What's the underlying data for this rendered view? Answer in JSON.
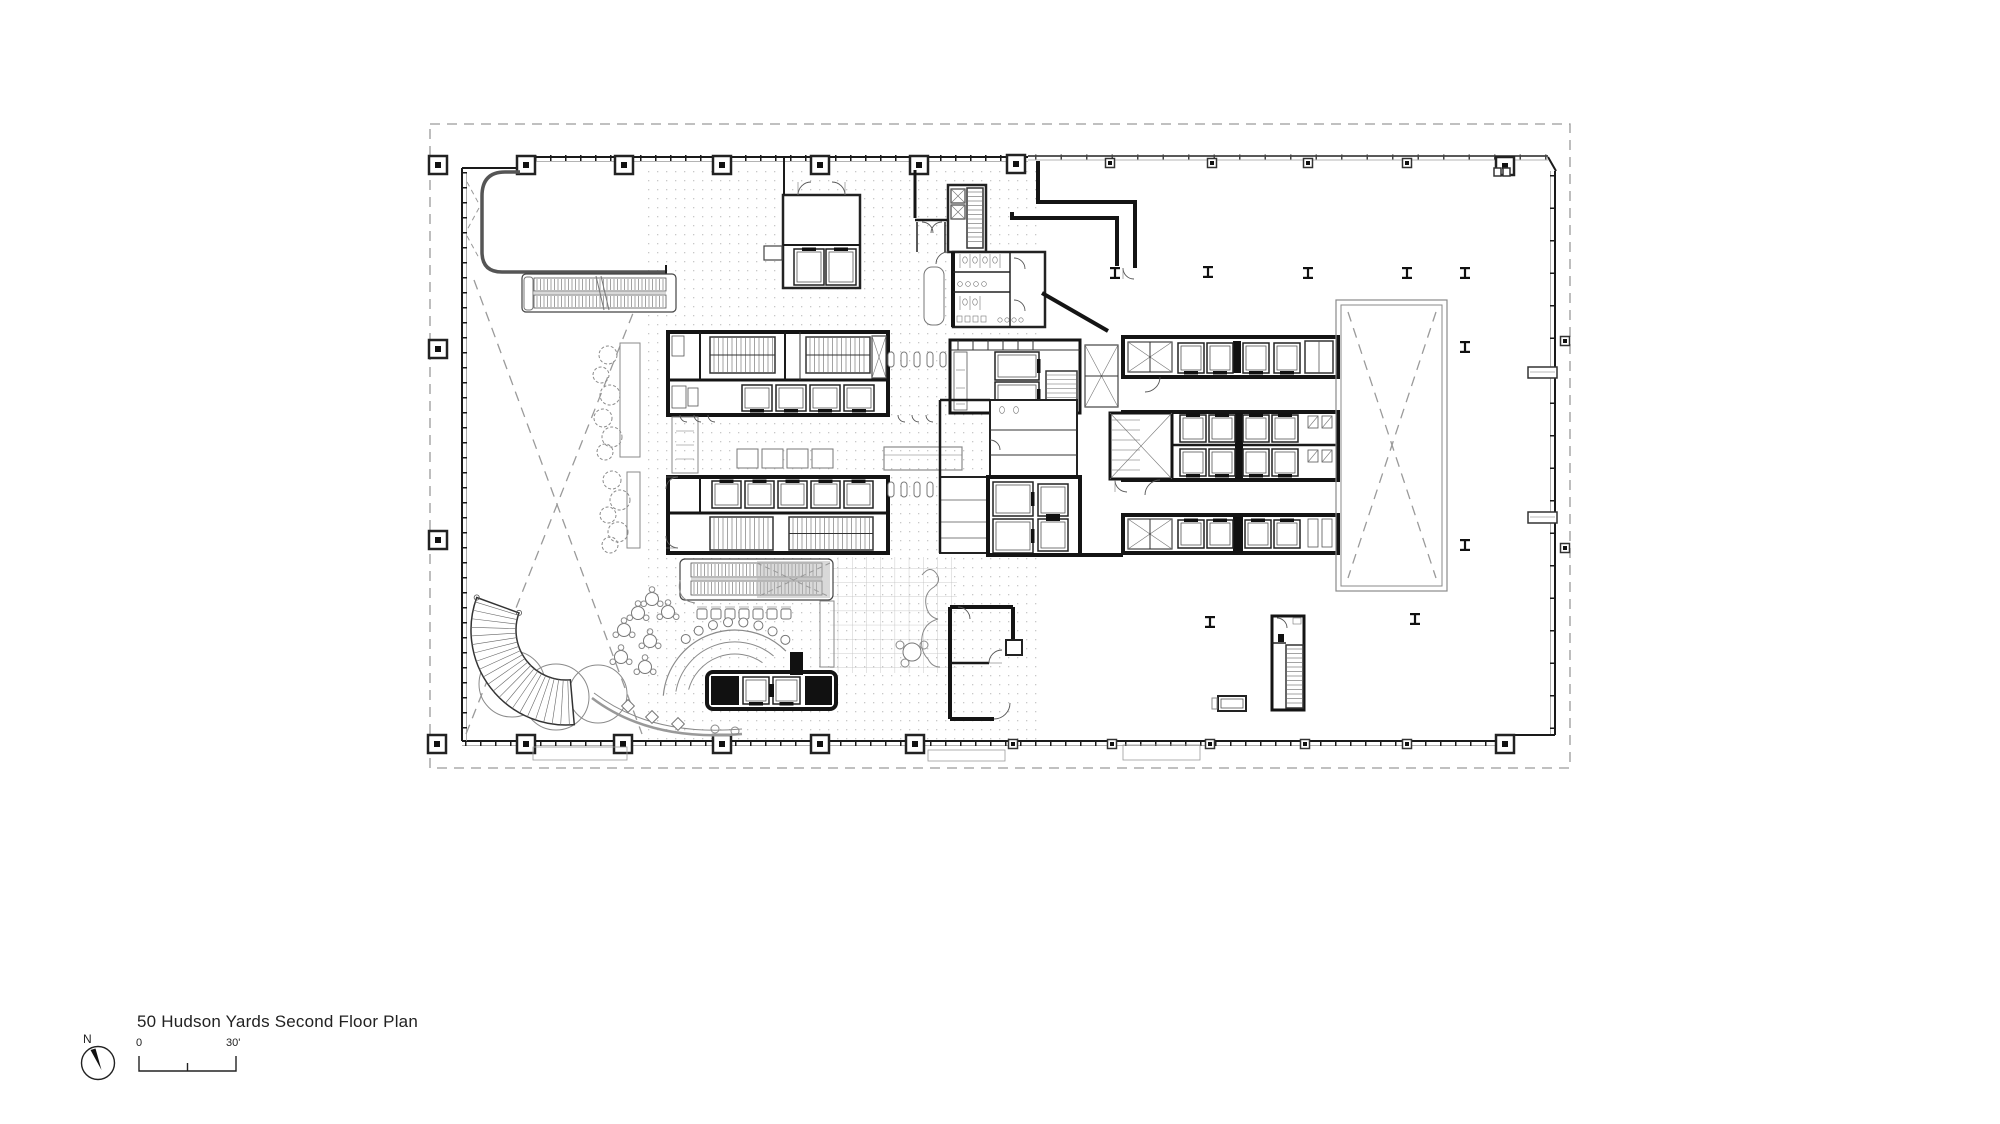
{
  "caption": {
    "title": "50 Hudson Yards Second Floor Plan"
  },
  "north_arrow": {
    "label": "N"
  },
  "scale_bar": {
    "start": "0",
    "end": "30'"
  },
  "colors": {
    "background": "#ffffff",
    "ink": "#1a1a1a",
    "medium_line": "#555555",
    "light_line": "#9a9a9a",
    "property_line": "#9a9a9a",
    "floor_grid": "#c8c8c8",
    "escalator_gray": "#b3b3b3"
  }
}
